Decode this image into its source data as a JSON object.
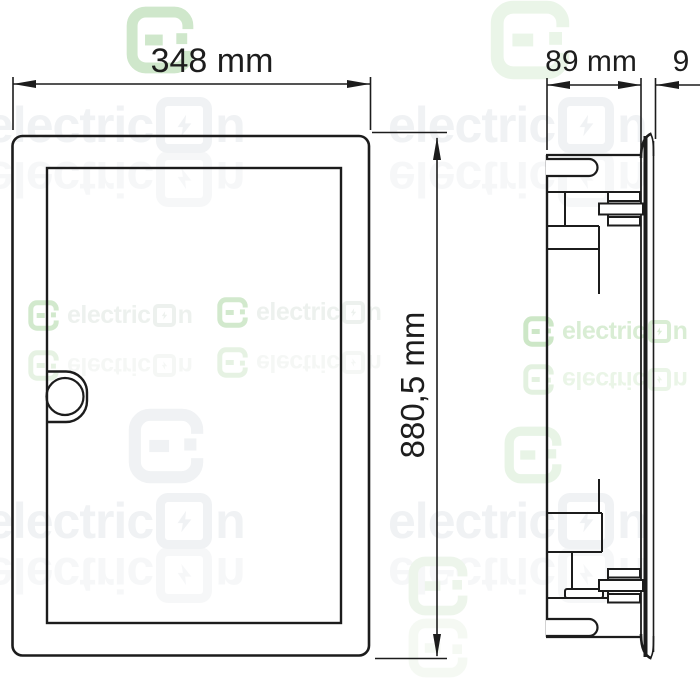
{
  "dimensions": {
    "front_width": "348 mm",
    "front_height": "880,5 mm",
    "side_depth": "89 mm",
    "side_gap": "9"
  },
  "watermark": {
    "brand": "electricon",
    "brand_prefix": "electric",
    "brand_suffix": "n"
  },
  "colors": {
    "line": "#1c1c1c",
    "watermark_gray": "#f0f2f4",
    "watermark_green": "#cfe7cb",
    "background": "#ffffff"
  }
}
